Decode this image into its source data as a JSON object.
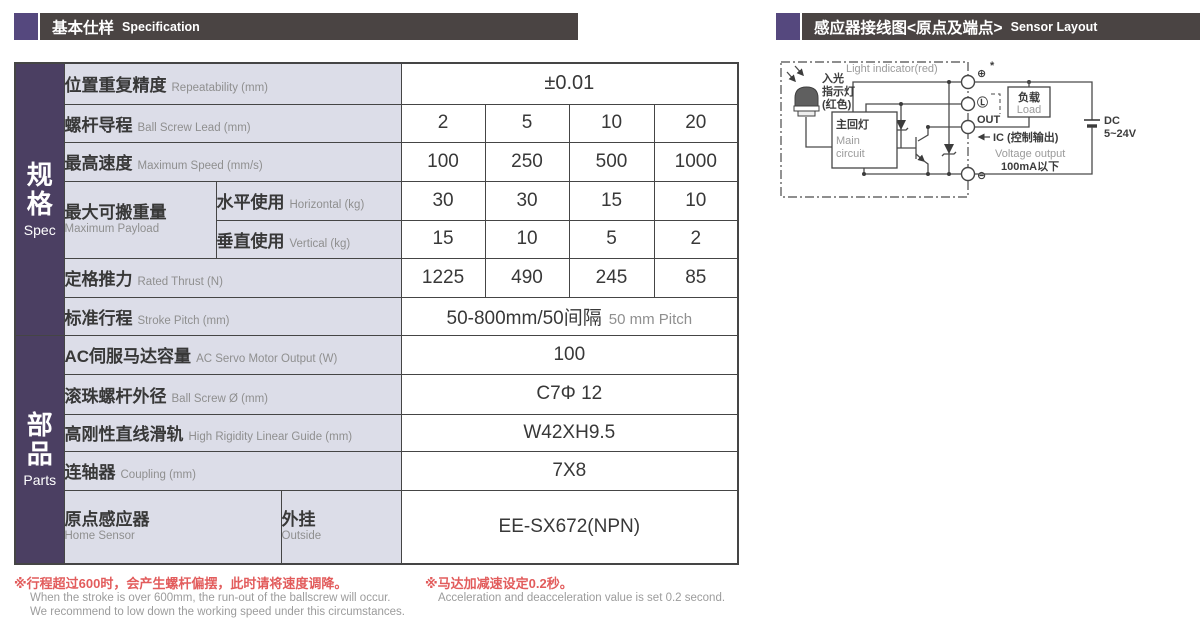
{
  "colors": {
    "accent_purple": "#55487e",
    "header_bar_bg": "#4a4443",
    "sidebar_purple": "#4b3f62",
    "label_cell_bg": "#dcdde8",
    "note_red": "#e25c5c"
  },
  "header_left": {
    "zh": "基本仕样",
    "en": "Specification"
  },
  "header_right": {
    "zh": "感应器接线图<原点及端点>",
    "en": "Sensor Layout"
  },
  "sidebar": {
    "spec": {
      "c1": "规",
      "c2": "格",
      "en": "Spec"
    },
    "parts": {
      "c1": "部",
      "c2": "品",
      "en": "Parts"
    }
  },
  "table": {
    "repeatability": {
      "zh": "位置重复精度",
      "en": "Repeatability (mm)",
      "value": "±0.01"
    },
    "lead": {
      "zh": "螺杆导程",
      "en": "Ball Screw Lead (mm)",
      "values": [
        "2",
        "5",
        "10",
        "20"
      ]
    },
    "speed": {
      "zh": "最高速度",
      "en": "Maximum Speed (mm/s)",
      "values": [
        "100",
        "250",
        "500",
        "1000"
      ]
    },
    "payload": {
      "zh": "最大可搬重量",
      "en": "Maximum Payload"
    },
    "payload_h": {
      "zh": "水平使用",
      "en": "Horizontal (kg)",
      "values": [
        "30",
        "30",
        "15",
        "10"
      ]
    },
    "payload_v": {
      "zh": "垂直使用",
      "en": "Vertical (kg)",
      "values": [
        "15",
        "10",
        "5",
        "2"
      ]
    },
    "thrust": {
      "zh": "定格推力",
      "en": "Rated Thrust (N)",
      "values": [
        "1225",
        "490",
        "245",
        "85"
      ]
    },
    "stroke": {
      "zh": "标准行程",
      "en": "Stroke Pitch (mm)",
      "value_zh": "50-800mm/50间隔",
      "value_en": "50 mm Pitch"
    },
    "servo": {
      "zh": "AC伺服马达容量",
      "en": "AC Servo Motor Output (W)",
      "value": "100"
    },
    "screw_dia": {
      "zh": "滚珠螺杆外径",
      "en": "Ball Screw Ø (mm)",
      "value": "C7Φ 12"
    },
    "guide": {
      "zh": "高刚性直线滑轨",
      "en": "High Rigidity Linear Guide (mm)",
      "value": "W42XH9.5"
    },
    "coupling": {
      "zh": "连轴器",
      "en": "Coupling (mm)",
      "value": "7X8"
    },
    "home_sensor": {
      "zh": "原点感应器",
      "en": "Home Sensor",
      "sub_zh": "外挂",
      "sub_en": "Outside",
      "value": "EE-SX672(NPN)"
    }
  },
  "notes": {
    "note1_zh": "※行程超过600时，会产生螺杆偏摆，此时请将速度调降。",
    "note1_en1": "When the stroke is over 600mm, the run-out of the ballscrew will occur.",
    "note1_en2": "We recommend to low down the working speed under this circumstances.",
    "note2_zh": "※马达加减速设定0.2秒。",
    "note2_en": "Acceleration and deacceleration value is set 0.2 second."
  },
  "diagram": {
    "light_indicator_en": "Light indicator(red)",
    "light_zh1": "入光",
    "light_zh2": "指示灯",
    "light_zh3": "(红色)",
    "main_circuit_zh": "主回灯",
    "main_circuit_en1": "Main",
    "main_circuit_en2": "circuit",
    "terminal_plus": "⊕",
    "asterisk": "*",
    "terminal_l": "Ⓛ",
    "terminal_out": "OUT",
    "terminal_minus": "⊖",
    "load_zh": "负载",
    "load_en": "Load",
    "ic_label": "IC (控制输出)",
    "voltage_output": "Voltage output",
    "current_limit": "100mA以下",
    "dc1": "DC",
    "dc2": "5~24V"
  }
}
